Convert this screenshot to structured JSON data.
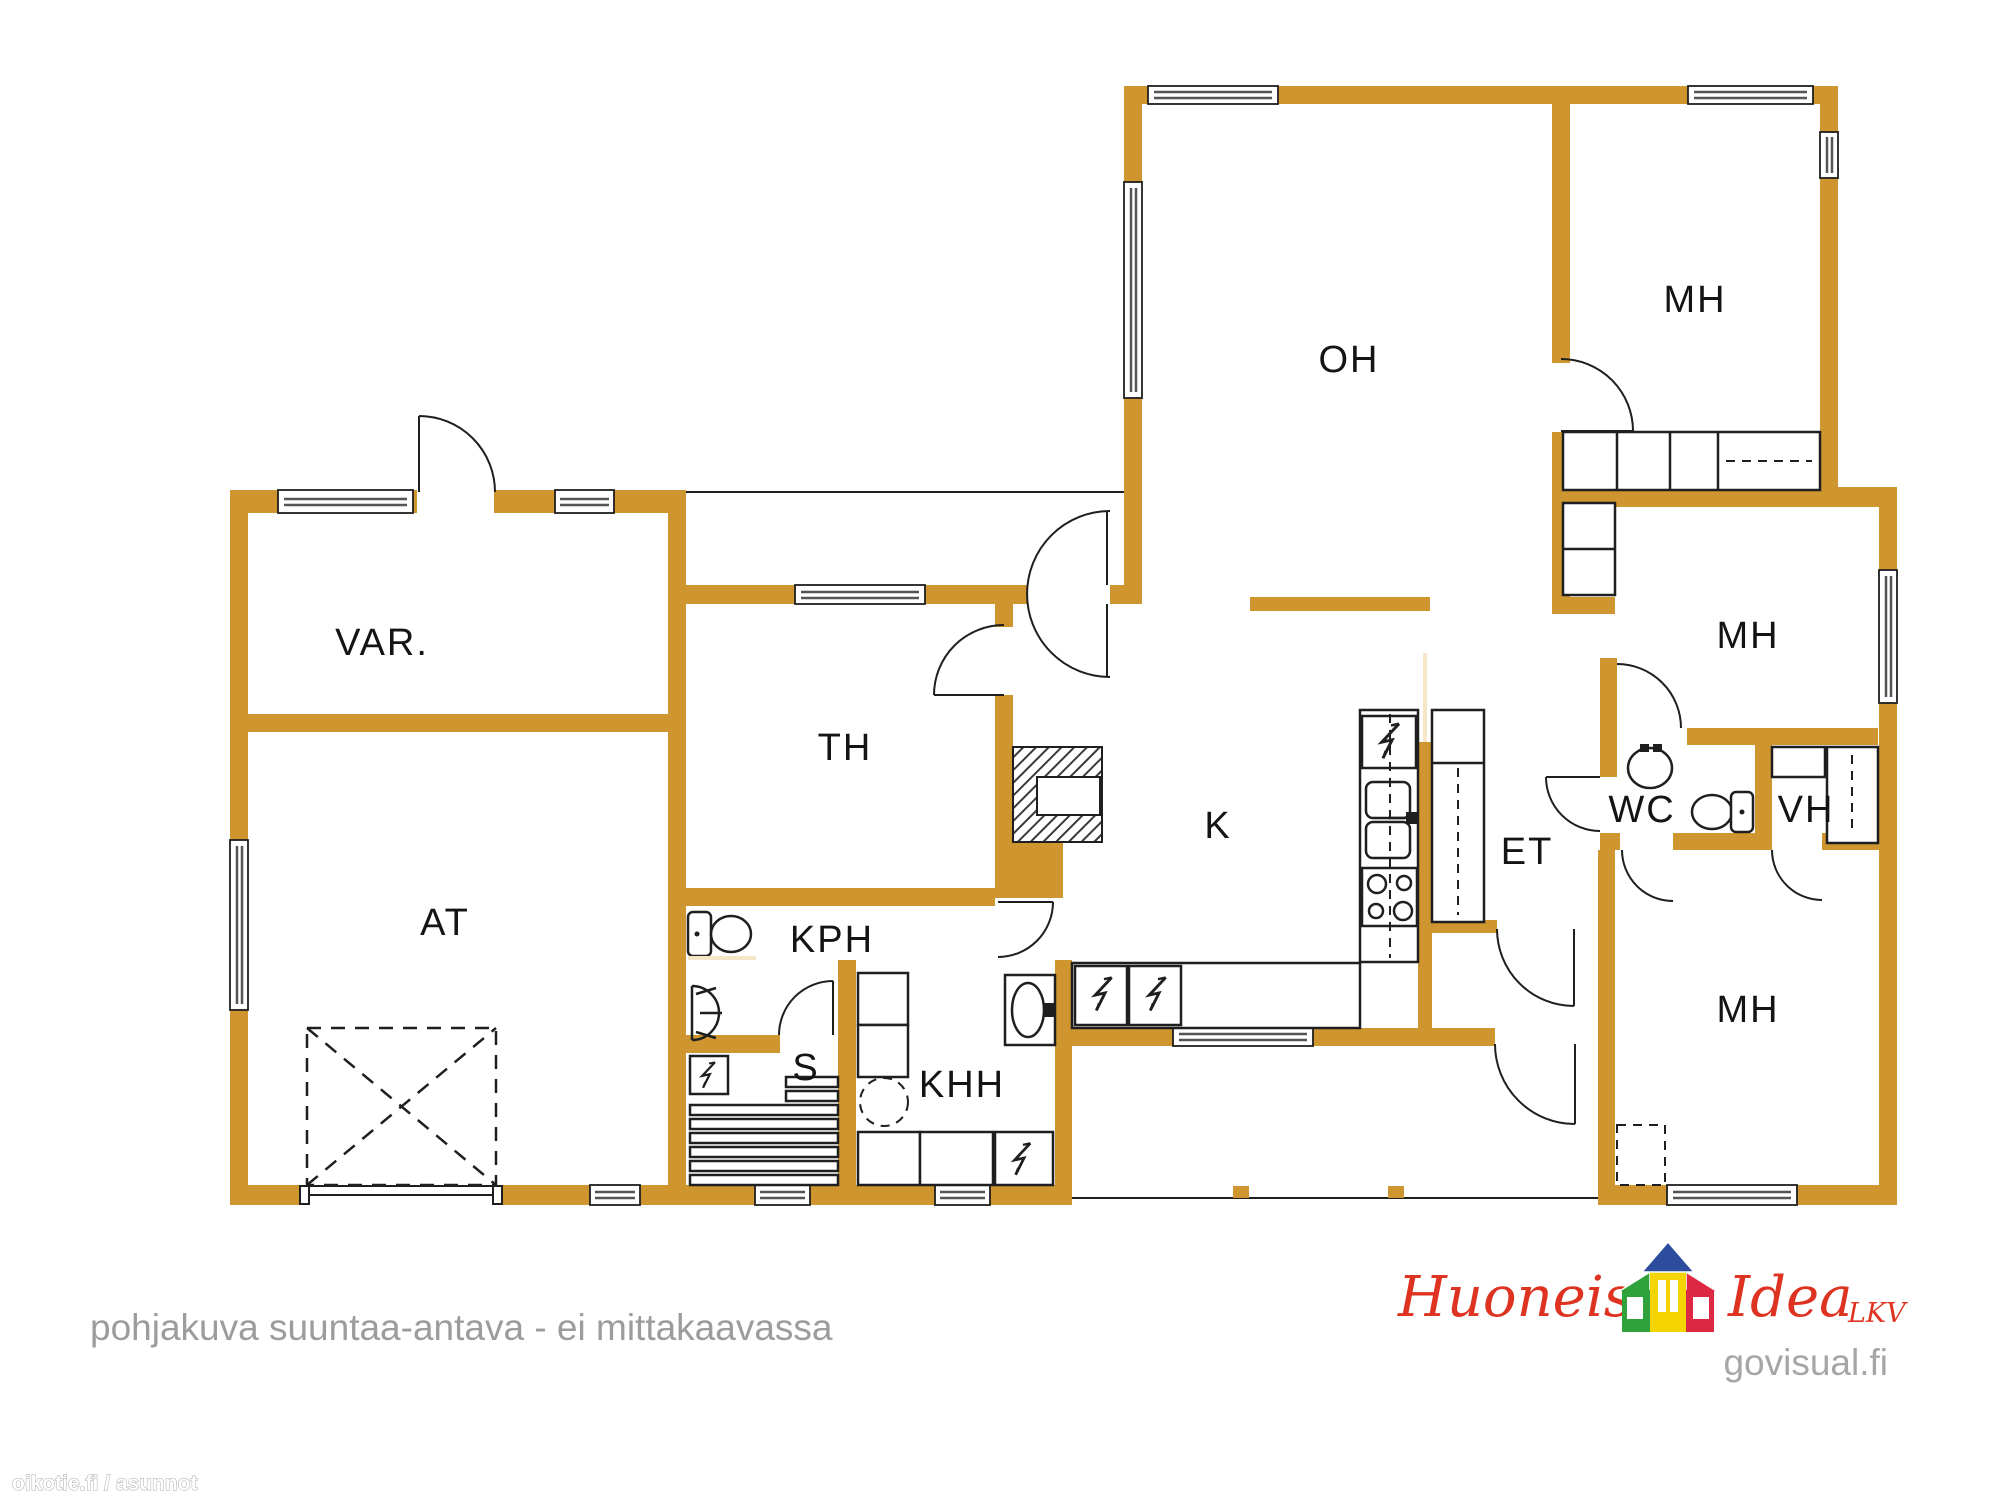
{
  "rooms": {
    "var": "VAR.",
    "at": "AT",
    "th": "TH",
    "kph": "KPH",
    "s": "S",
    "khh": "KHH",
    "k": "K",
    "oh": "OH",
    "mh_top": "MH",
    "mh_mid": "MH",
    "mh_bottom": "MH",
    "wc": "WC",
    "vh": "VH",
    "et": "ET"
  },
  "annotations": {
    "disclaimer": "pohjakuva suuntaa-antava - ei mittakaavassa",
    "watermark": "oikotie.fi / asunnot"
  },
  "branding": {
    "brand_word_1": "Huoneisto",
    "brand_word_2": "Idea",
    "brand_suffix": "LKV",
    "website": "govisual.fi",
    "icon": "house-logo-icon"
  },
  "colors": {
    "wall": "#CF9630",
    "line": "#1F1F1F",
    "pale": "#F5E6C8",
    "text_gray": "#9C9C9C",
    "brand_red": "#DF3322",
    "site_gray": "#A6A6A6",
    "logo_green": "#2FA23C",
    "logo_yellow": "#F4D503",
    "logo_red": "#DD2843",
    "logo_blue": "#2C4C9E"
  }
}
